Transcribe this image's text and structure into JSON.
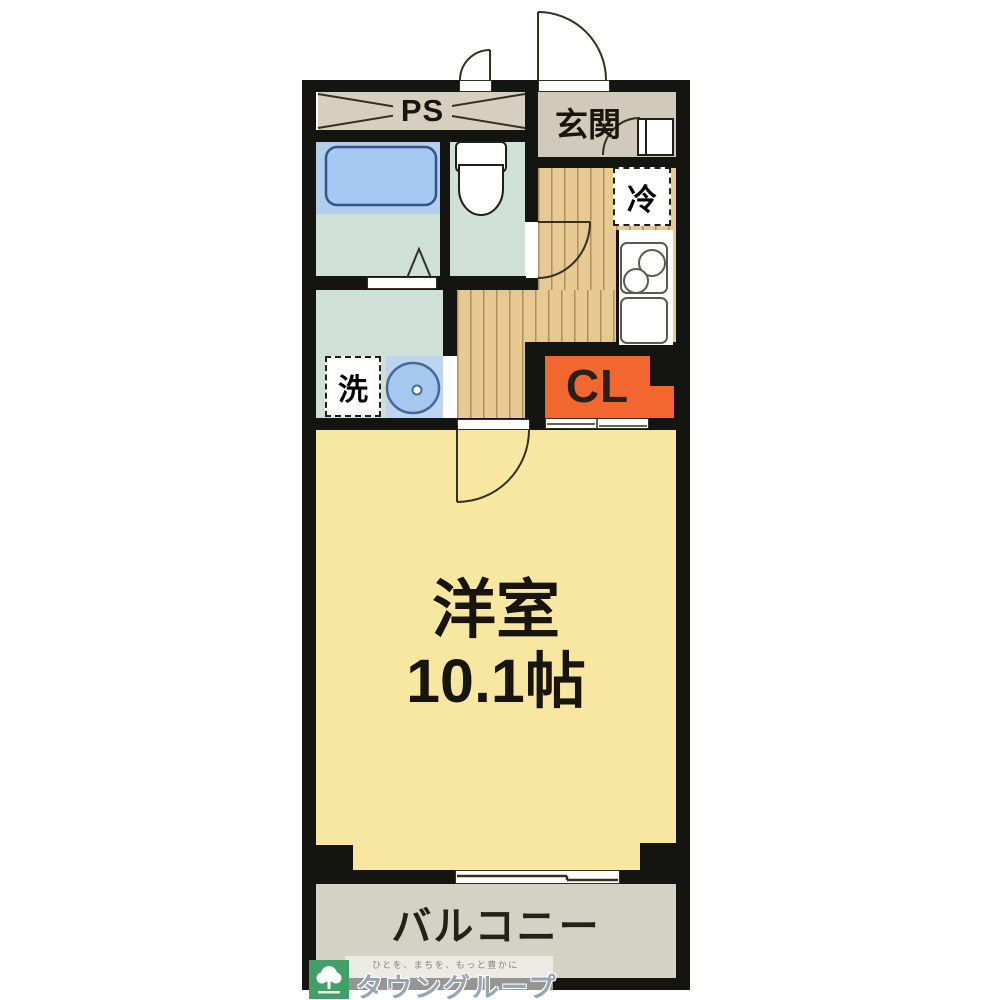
{
  "plan": {
    "rooms": {
      "ps": "PS",
      "entrance": "玄関",
      "refrigerator": "冷",
      "laundry": "洗",
      "closet": "CL",
      "main_room_name": "洋室",
      "main_room_size": "10.1帖",
      "balcony": "バルコニー"
    },
    "logo": {
      "tagline": "ひとを、まちを、もっと豊かに",
      "name": "タウングループ"
    },
    "colors": {
      "wall": "#141411",
      "line_dark": "#32301f",
      "ps_beige": "#d6cfc0",
      "genkan_beige": "#d1cabb",
      "wood": "#e7c993",
      "sage": "#cfe0d8",
      "tub_band": "#b4cdec",
      "tub_fill": "#a5c9f2",
      "blue_stroke": "#31548a",
      "basin_bg": "#bdd4ee",
      "basin_fill": "#a6c8ef",
      "room_yellow": "#f8e7a0",
      "balcony_gray": "#d4d1c5",
      "closet_orange": "#f2662f",
      "logo_green": "#41a066",
      "logo_text": "#97a4b2"
    }
  }
}
